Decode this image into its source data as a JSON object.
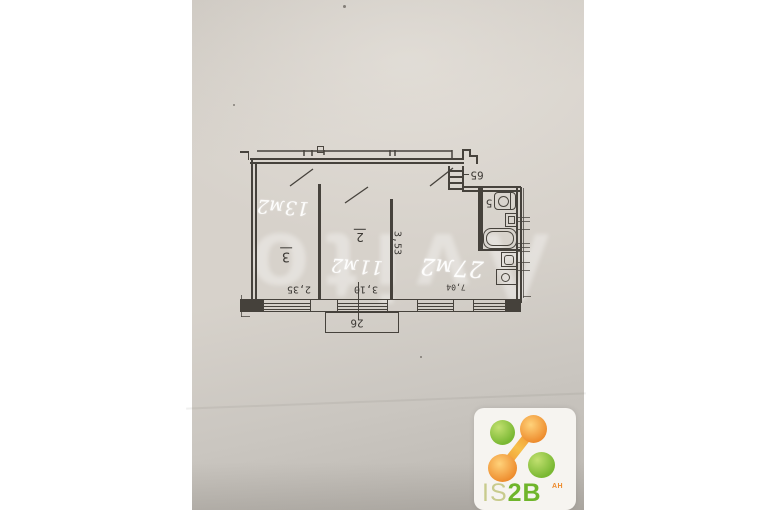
{
  "watermark": {
    "text": "Avito"
  },
  "plan": {
    "rooms": [
      {
        "number": "3",
        "area": "13м2",
        "width": "2,35"
      },
      {
        "number": "2",
        "area": "11м2",
        "width": "3,10",
        "depth": "3,53"
      },
      {
        "area": "27м2",
        "width": "7,04"
      }
    ],
    "bathroom": {
      "label": "5"
    },
    "entry": {
      "label": "65"
    },
    "balcony": {
      "label": "26"
    }
  },
  "logo": {
    "part_light": "IS",
    "part_bold": "2B",
    "suffix": "АН",
    "green": "#6fb52b",
    "orange": "#ed8a2b"
  }
}
